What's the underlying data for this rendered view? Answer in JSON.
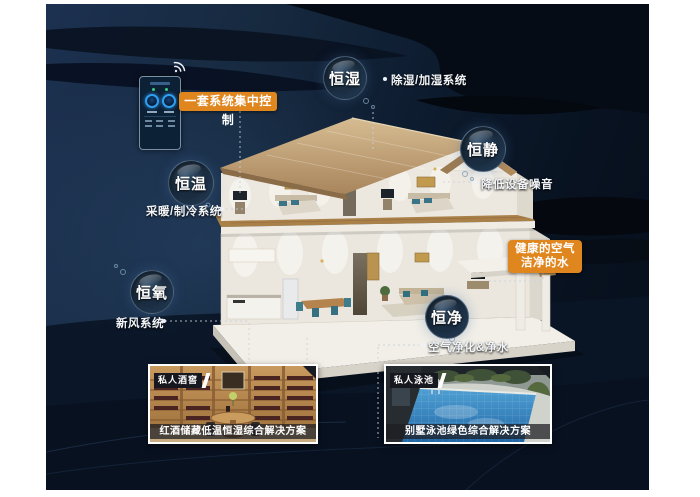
{
  "control": {
    "label": "一套系统集中控制"
  },
  "bubbles": [
    {
      "label": "恒湿",
      "desc": "除湿/加湿系统"
    },
    {
      "label": "恒静",
      "desc": "降低设备噪音"
    },
    {
      "label": "恒温",
      "desc": "采暖/制冷系统"
    },
    {
      "label": "恒氧",
      "desc": "新风系统"
    },
    {
      "label": "恒净",
      "desc": "空气净化&净水"
    }
  ],
  "highlight_box": {
    "line1": "健康的空气",
    "line2": "洁净的水"
  },
  "cards": [
    {
      "badge": "私人酒窖",
      "caption": "红酒储藏低温恒湿综合解决方案"
    },
    {
      "badge": "私人泳池",
      "caption": "别墅泳池绿色综合解决方案"
    }
  ],
  "icons": {
    "wifi": "wifi-icon"
  },
  "colors": {
    "accent_orange": "#e0861f",
    "panel_navy": "#14273e",
    "bubble_rim": "#7fa3c4"
  }
}
